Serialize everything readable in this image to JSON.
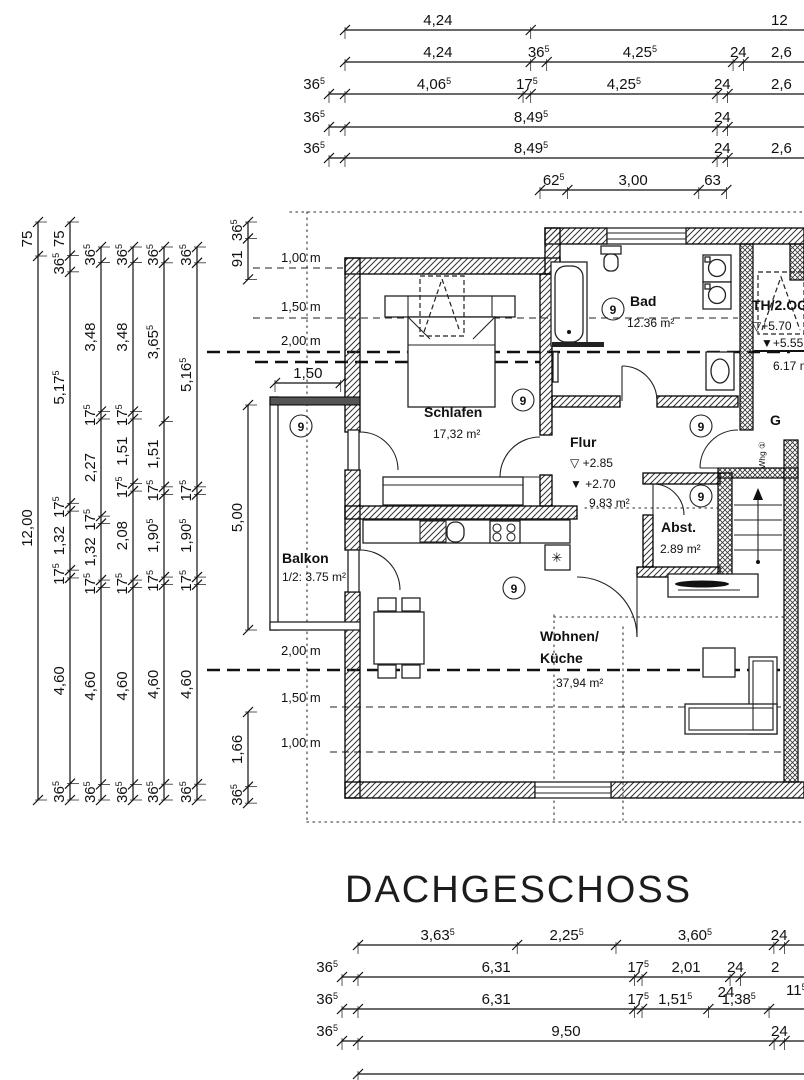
{
  "title": "DACHGESCHOSS",
  "plan": {
    "marker": "9",
    "flue_symbol": "✳",
    "rooms": {
      "schlafen": {
        "name": "Schlafen",
        "area": "17,32 m²"
      },
      "bad": {
        "name": "Bad",
        "area": "12.36 m²"
      },
      "flur": {
        "name": "Flur",
        "level_upper": "▽ +2.85",
        "level_lower": "▼ +2.70",
        "area": "9.83 m²"
      },
      "abstellraum": {
        "name": "Abst.",
        "area": "2.89 m²"
      },
      "wohnen": {
        "name_line1": "Wohnen/",
        "name_line2": "Küche",
        "area": "37,94 m²"
      },
      "balkon": {
        "name": "Balkon",
        "area": "1/2: 3.75 m²"
      },
      "treppenhaus": {
        "name": "TH/2.OG",
        "level_upper": "▽+5.70",
        "level_lower": "▼+5.55",
        "area": "6.17 m²"
      },
      "g_label": "G",
      "whg": "Whg ①"
    },
    "height_lines": {
      "top": [
        "1,00 m",
        "1,50 m",
        "2,00 m"
      ],
      "bottom": [
        "2,00 m",
        "1,50 m",
        "1,00 m"
      ]
    }
  },
  "dims": {
    "top": [
      {
        "segs": [
          "4,24"
        ],
        "tail": "12"
      },
      {
        "segs": [
          "4,24",
          "36⁵",
          "4,25⁵",
          "24"
        ],
        "tail": "2,6"
      },
      {
        "segs": [
          "36⁵",
          "4,06⁵",
          "17⁵",
          "4,25⁵",
          "24"
        ],
        "tail": "2,6"
      },
      {
        "segs": [
          "36⁵",
          "8,49⁵",
          "24"
        ],
        "tail": ""
      },
      {
        "segs": [
          "36⁵",
          "8,49⁵",
          "24"
        ],
        "tail": "2,6"
      },
      {
        "segs": [
          "62⁵",
          "3,00",
          "63"
        ],
        "tail": null
      }
    ],
    "left": [
      {
        "segs": [
          "75",
          "12,00"
        ]
      },
      {
        "segs": [
          "75",
          "36⁵",
          "5,17⁵",
          "17⁵",
          "1,32",
          "17⁵",
          "4,60",
          "36⁵"
        ]
      },
      {
        "segs": [
          "36⁵",
          "3,48",
          "17⁵",
          "2,27",
          "17⁵",
          "1,32",
          "17⁵",
          "4,60",
          "36⁵"
        ]
      },
      {
        "segs": [
          "36⁵",
          "3,48",
          "17⁵",
          "1,51",
          "17⁵",
          "2,08",
          "17⁵",
          "4,60",
          "36⁵"
        ]
      },
      {
        "segs": [
          "36⁵",
          "3,65⁵",
          "1,51",
          "17⁵",
          "1,90⁵",
          "17⁵",
          "4,60",
          "36⁵"
        ]
      },
      {
        "segs": [
          "36⁵",
          "5,16⁵",
          "17⁵",
          "1,90⁵",
          "17⁵",
          "4,60",
          "36⁵"
        ]
      },
      {
        "segs": [
          "36⁵",
          "91"
        ]
      },
      {
        "segs": [
          "1,66",
          "36⁵"
        ]
      },
      {
        "segs": [
          "5,00"
        ]
      }
    ],
    "extra_h": [
      {
        "segs": [
          "1,50"
        ]
      }
    ],
    "bottom": [
      {
        "segs": [
          "3,63⁵",
          "2,25⁵",
          "3,60⁵",
          "24"
        ],
        "tail": ""
      },
      {
        "segs": [
          "36⁵",
          "6,31",
          "17⁵",
          "2,01",
          "24"
        ],
        "tail": "2"
      },
      {
        "segs": [
          "36⁵",
          "6,31",
          "17⁵",
          "1,51⁵",
          "1,38⁵"
        ],
        "tail": ""
      },
      {
        "segs": [
          "36⁵",
          "9,50",
          "24"
        ],
        "tail": ""
      },
      {
        "segs": [],
        "tail": ""
      }
    ],
    "floaters": [
      "24",
      "11⁵"
    ]
  }
}
